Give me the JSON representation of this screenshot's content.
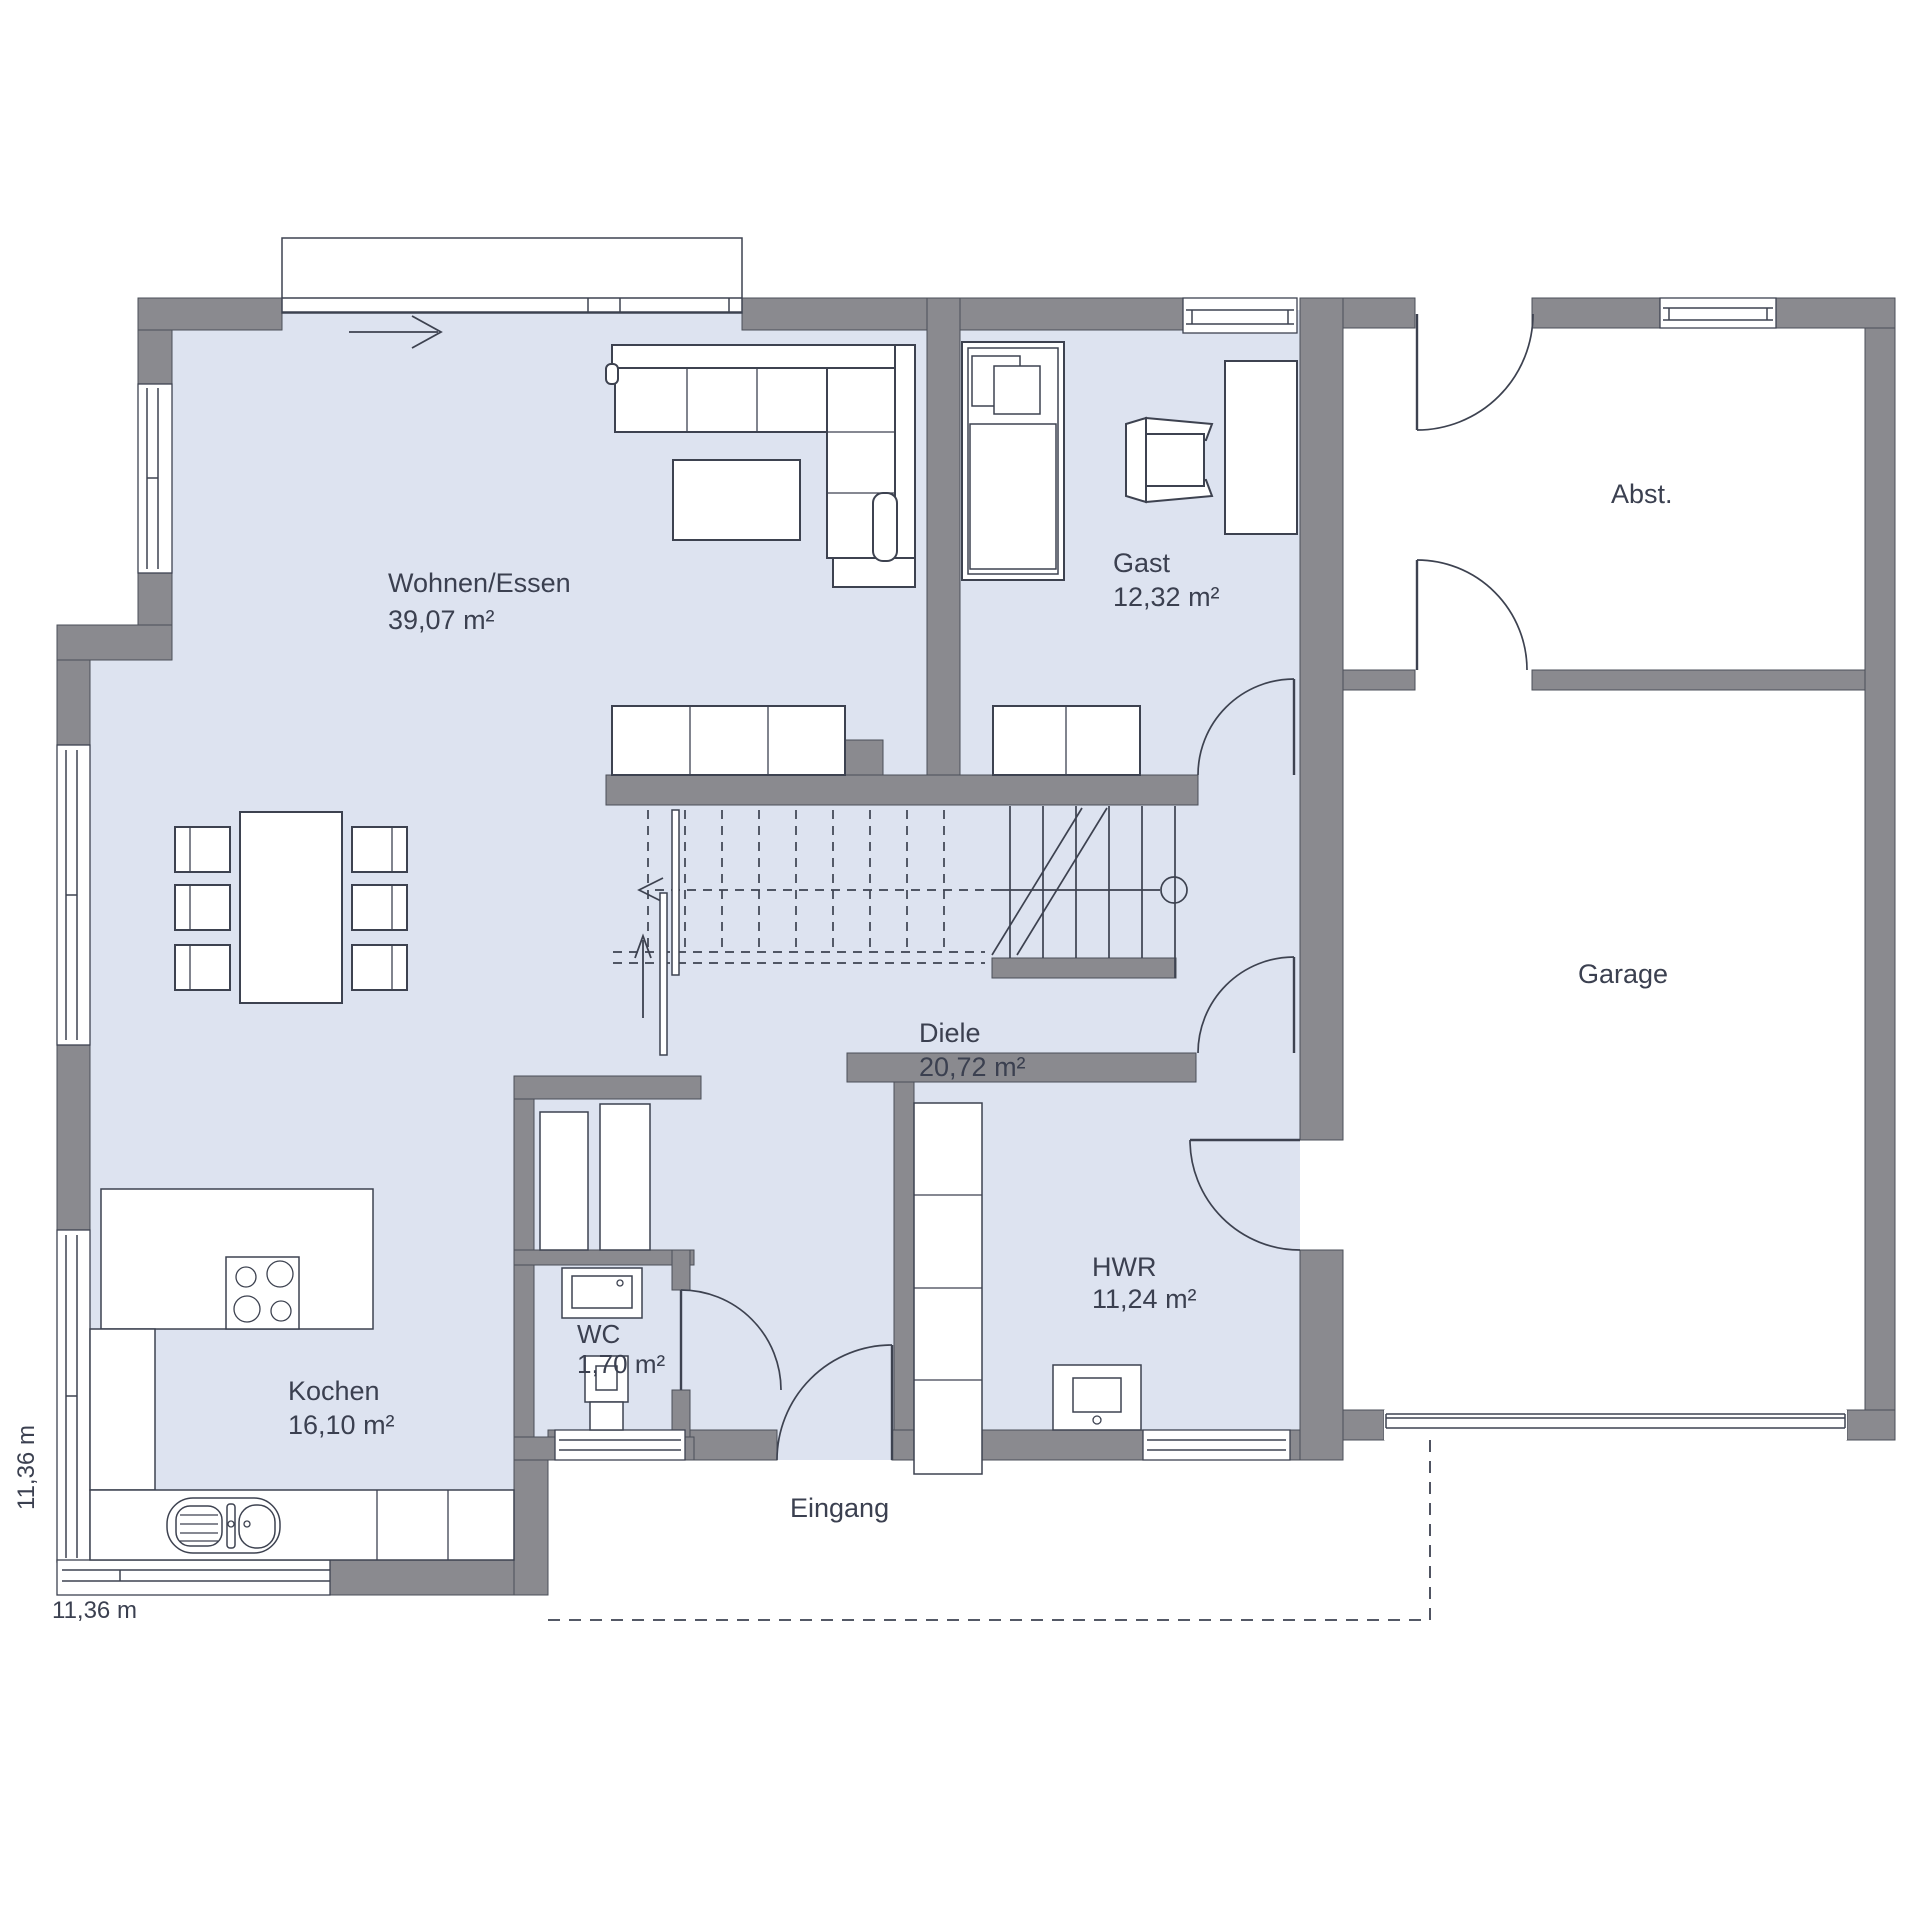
{
  "plan": {
    "type": "floor-plan",
    "rooms": {
      "wohnen": {
        "name": "Wohnen/Essen",
        "area": "39,07 m²"
      },
      "gast": {
        "name": "Gast",
        "area": "12,32 m²"
      },
      "abst": {
        "name": "Abst."
      },
      "garage": {
        "name": "Garage"
      },
      "diele": {
        "name": "Diele",
        "area": "20,72 m²"
      },
      "kochen": {
        "name": "Kochen",
        "area": "16,10 m²"
      },
      "wc": {
        "name": "WC",
        "area": "1,70 m²"
      },
      "hwr": {
        "name": "HWR",
        "area": "11,24 m²"
      }
    },
    "labels": {
      "entrance": "Eingang"
    },
    "dimensions": {
      "bottom": "11,36 m",
      "left": "11,36 m"
    },
    "colors": {
      "wall": "#8a8a8f",
      "floor": "#dde3f0",
      "line": "#3d4250",
      "text": "#3b4050",
      "background": "#ffffff"
    }
  }
}
